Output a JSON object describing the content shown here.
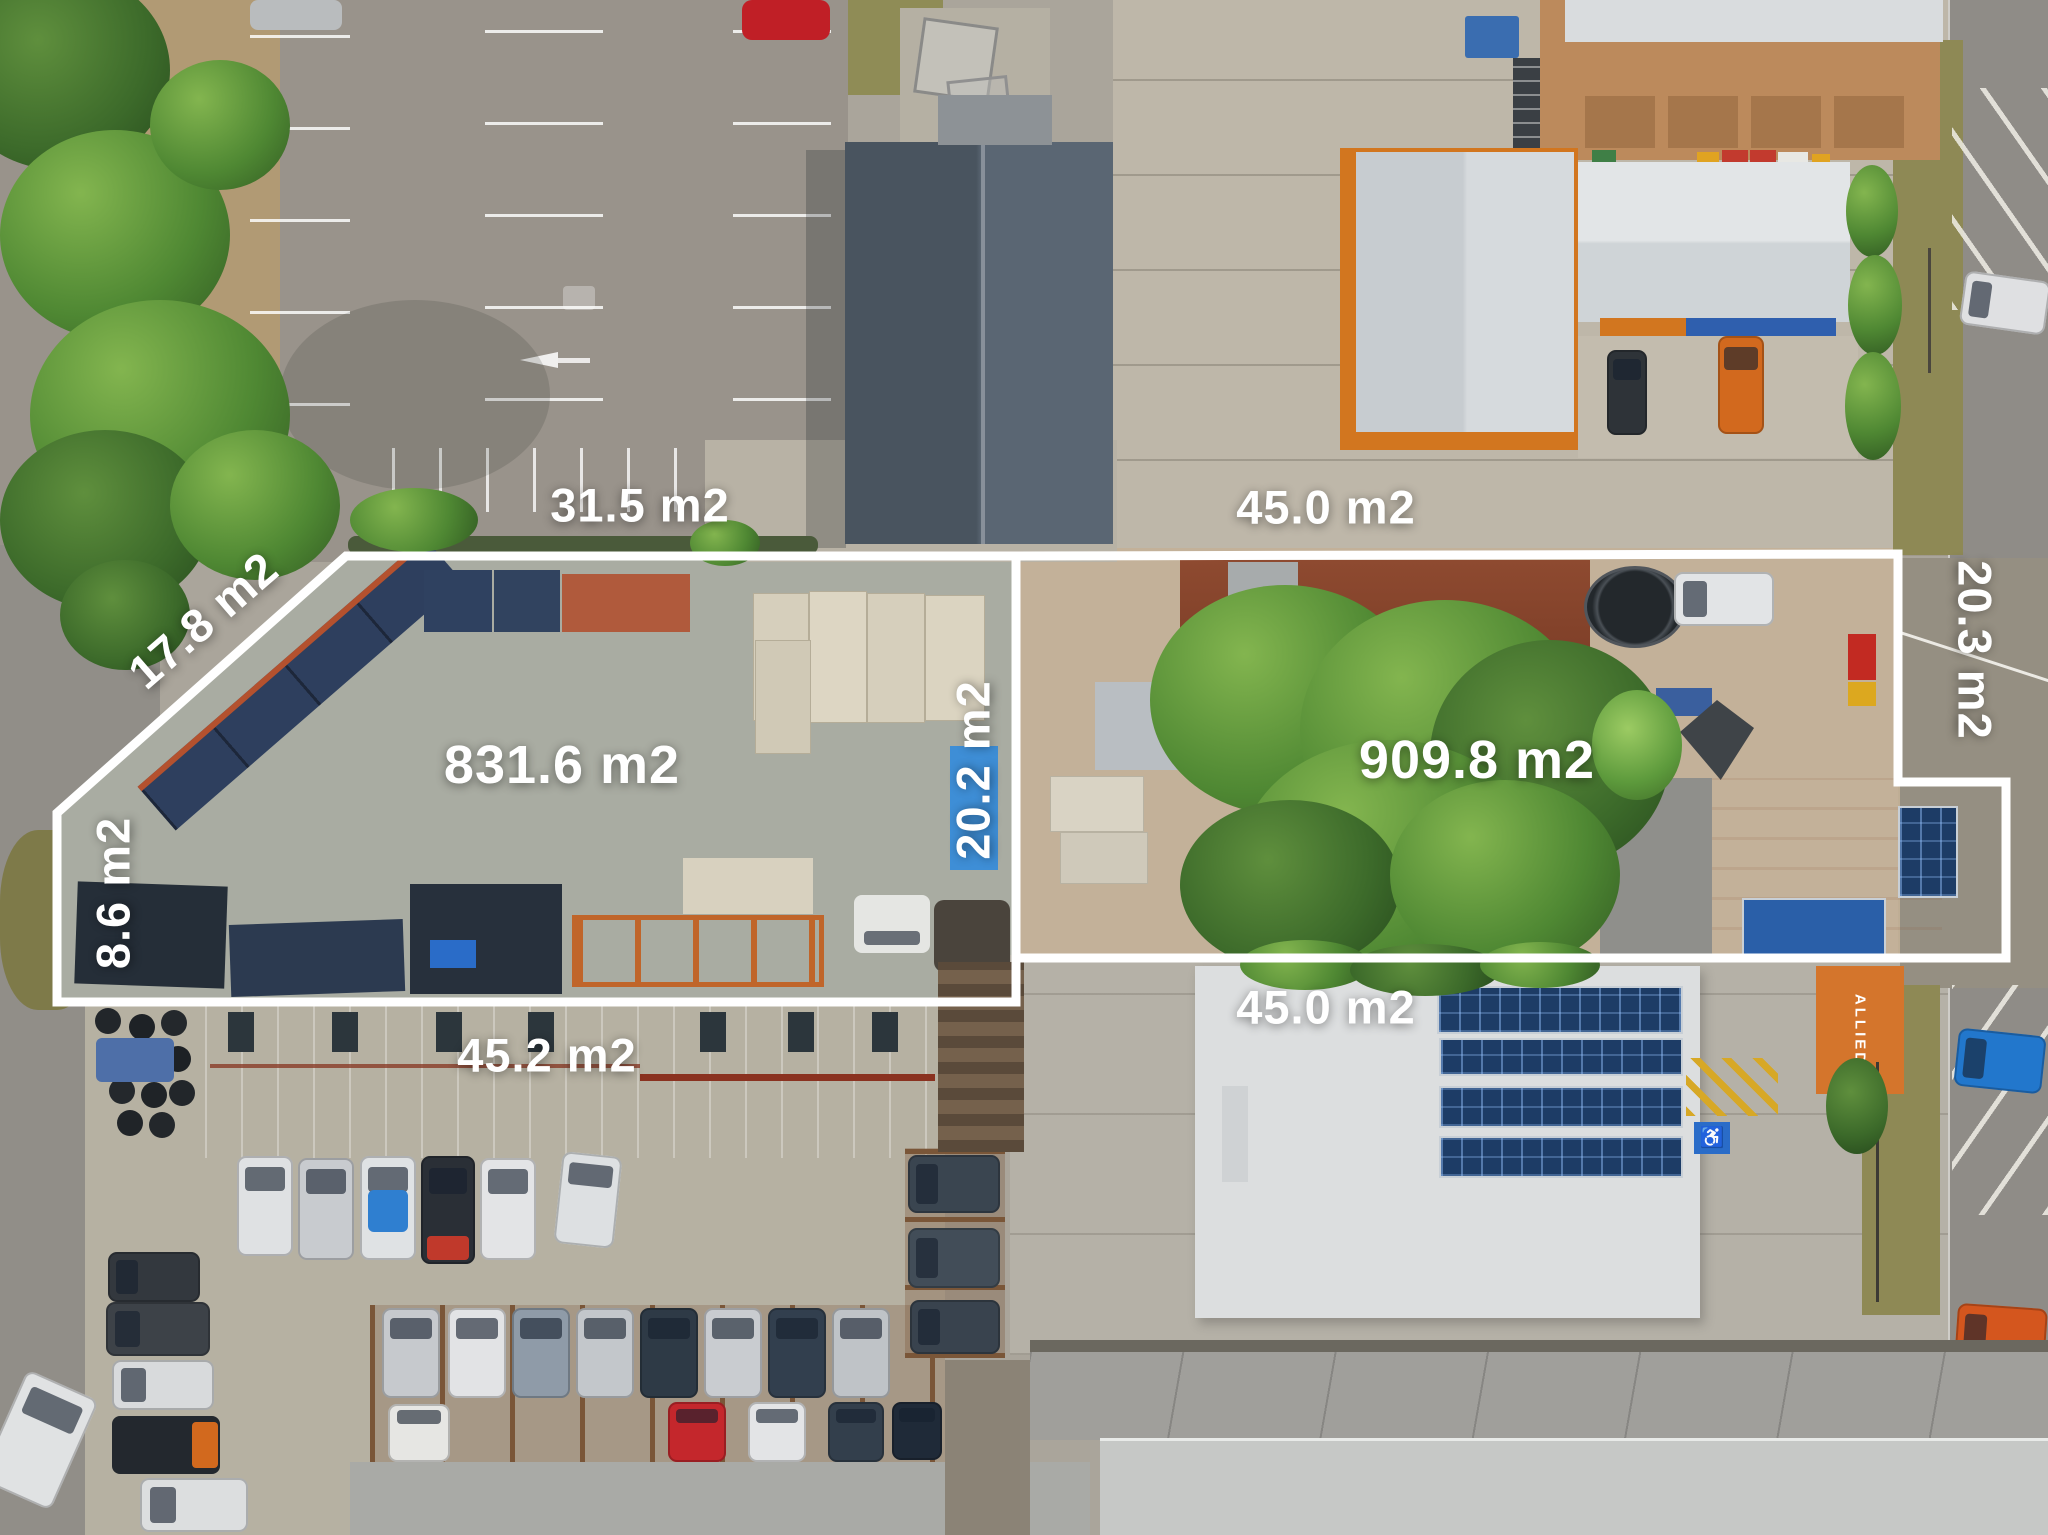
{
  "labels": {
    "area_31_5": "31.5 m2",
    "area_45_0_top": "45.0 m2",
    "area_17_8": "17.8 m2",
    "area_20_3": "20.3 m2",
    "area_831_6": "831.6 m2",
    "area_20_2": "20.2 m2",
    "area_909_8": "909.8 m2",
    "area_8_6": "8.6 m2",
    "area_45_2": "45.2 m2",
    "area_45_0_bottom": "45.0 m2",
    "container_text": "ALLIED"
  },
  "icons": {
    "disabled_parking": "♿"
  },
  "colors": {
    "boundary_line": "#ffffff",
    "label_text": "#ffffff",
    "asphalt": "#99938b",
    "gravel_lot1": "#a9aca2",
    "dirt_lot2": "#c3b199",
    "dark_roof": "#4e5965",
    "green_roof": "#97ab86",
    "white_roof": "#dcdedf",
    "orange_container": "#d4752c",
    "solar_panel": "#1d3c66"
  }
}
